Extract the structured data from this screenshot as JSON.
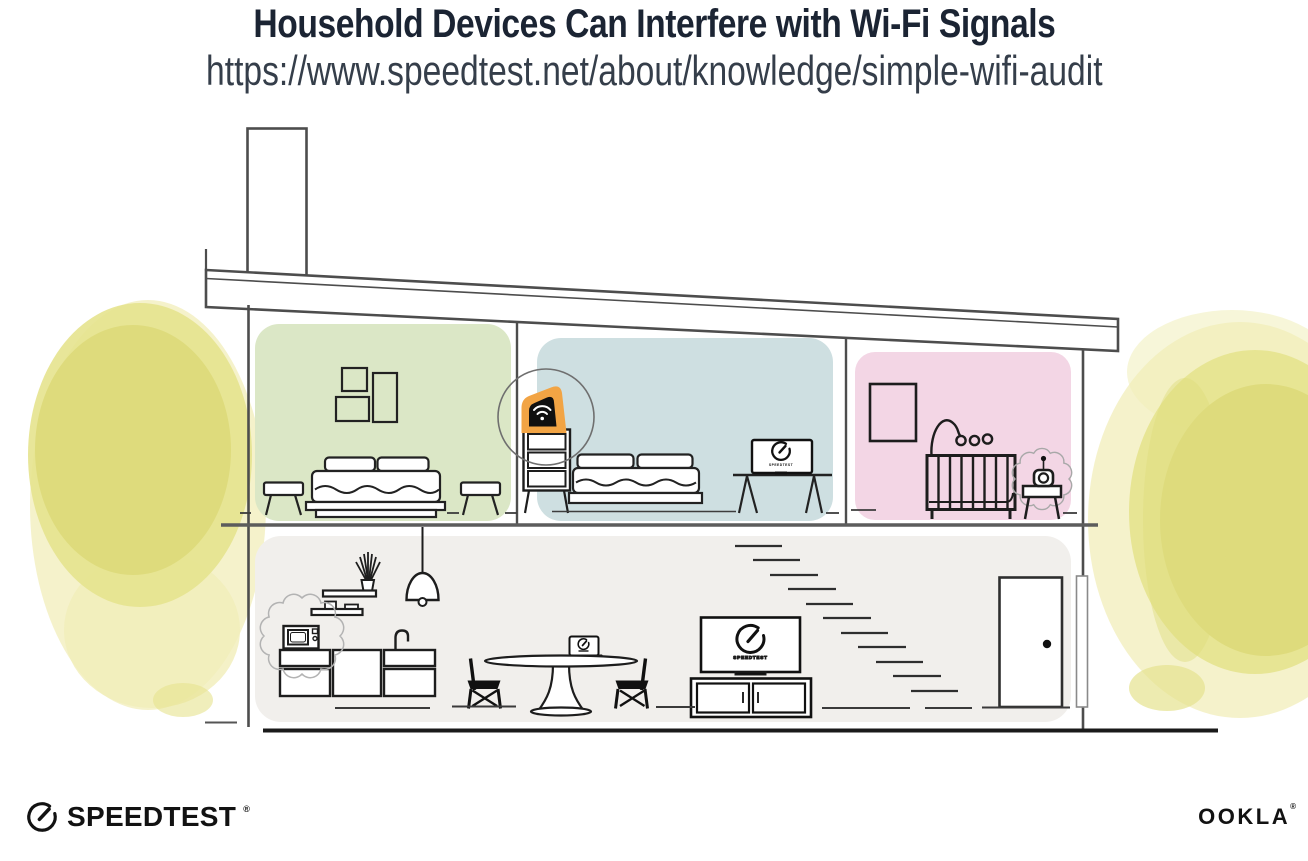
{
  "header": {
    "title": "Household Devices Can Interfere with Wi-Fi Signals",
    "url": "https://www.speedtest.net/about/knowledge/simple-wifi-audit"
  },
  "illustration": {
    "tv_screen_label": "SPEEDTEST",
    "monitor_screen_label": "SPEEDTEST"
  },
  "footer": {
    "speedtest_wordmark": "SPEEDTEST",
    "speedtest_trademark": "®",
    "ookla_wordmark": "OOKLA",
    "ookla_trademark": "®"
  },
  "colors": {
    "title_ink": "#1b2433",
    "url_ink": "#353e4a",
    "logo_ink": "#121212",
    "wall_line": "#4d4d4d",
    "device_ink": "#101010",
    "room_green": "#dbe7c6",
    "room_blue": "#cedfe1",
    "room_pink": "#f3d6e5",
    "room_gray": "#f1efec",
    "foliage_dark": "#dedb7c",
    "foliage_mid": "#e6e38e",
    "foliage_light": "#f1eeb9",
    "router_orange": "#f2a444"
  }
}
